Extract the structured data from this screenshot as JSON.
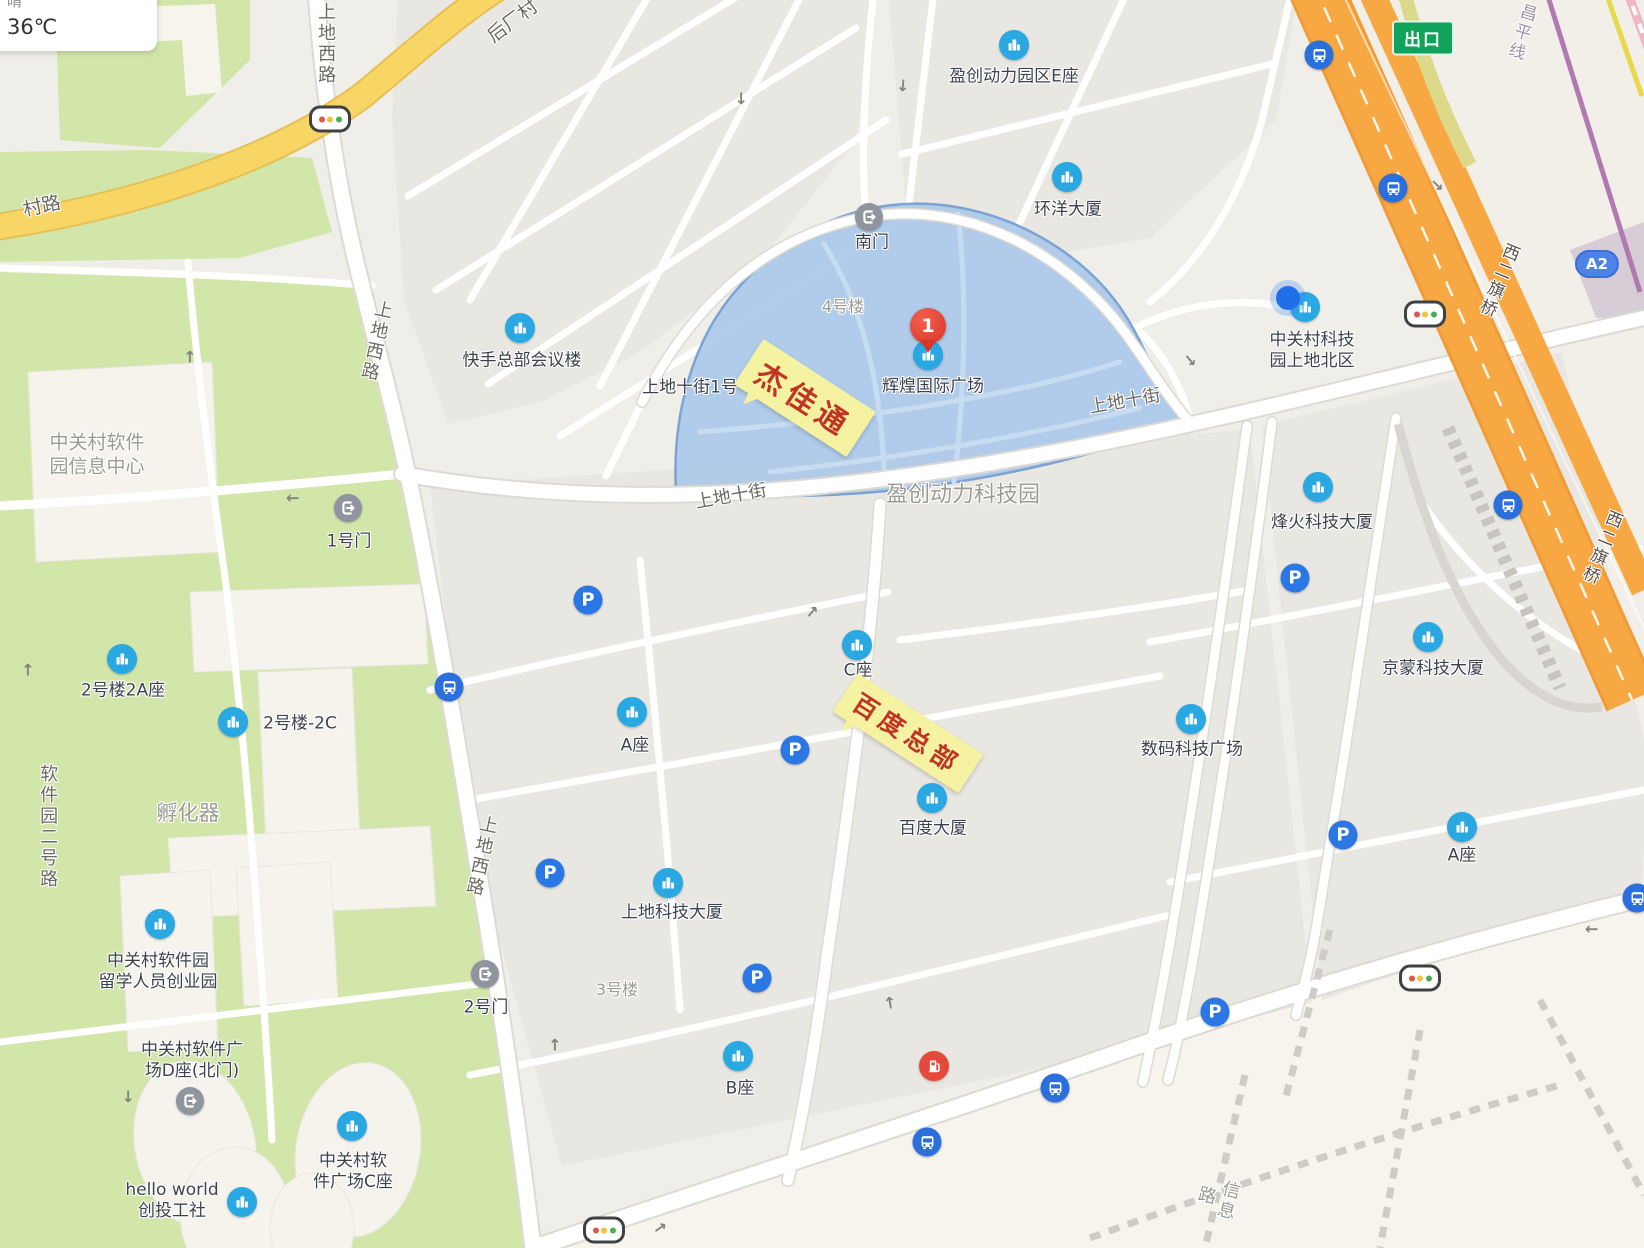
{
  "app": {
    "weather": {
      "condition": "晴",
      "temperature": "36℃"
    }
  },
  "marker": {
    "number": "1",
    "place": "辉煌国际广场",
    "x": 928,
    "y": 352
  },
  "callouts": [
    {
      "text": "杰佳通",
      "x": 805,
      "y": 398,
      "rotate": 33,
      "font_size": 30
    },
    {
      "text": "百度总部",
      "x": 908,
      "y": 733,
      "rotate": 33,
      "font_size": 25
    }
  ],
  "badges": [
    {
      "text": "出口",
      "type": "exit",
      "x": 1423,
      "y": 38
    },
    {
      "text": "A2",
      "type": "roadno",
      "x": 1597,
      "y": 264
    }
  ],
  "labels": [
    {
      "t": "盈创动力园区E座",
      "x": 1014,
      "y": 77,
      "c": "poi"
    },
    {
      "t": "环洋大厦",
      "x": 1068,
      "y": 210,
      "c": "poi"
    },
    {
      "t": "快手总部会议楼",
      "x": 522,
      "y": 361,
      "c": "poi"
    },
    {
      "t": "辉煌国际广场",
      "x": 933,
      "y": 387,
      "c": "poi"
    },
    {
      "t": "中关村科技\n园上地北区",
      "x": 1312,
      "y": 351,
      "c": "poi"
    },
    {
      "t": "烽火科技大厦",
      "x": 1322,
      "y": 523,
      "c": "poi"
    },
    {
      "t": "京蒙科技大厦",
      "x": 1433,
      "y": 669,
      "c": "poi"
    },
    {
      "t": "数码科技广场",
      "x": 1192,
      "y": 750,
      "c": "poi"
    },
    {
      "t": "A座",
      "x": 1462,
      "y": 856,
      "c": "poi"
    },
    {
      "t": "2号楼2A座",
      "x": 123,
      "y": 691,
      "c": "poi"
    },
    {
      "t": "2号楼-2C",
      "x": 300,
      "y": 724,
      "c": "poi"
    },
    {
      "t": "中关村软件园\n留学人员创业园",
      "x": 158,
      "y": 972,
      "c": "poi"
    },
    {
      "t": "中关村软件广\n场D座(北门)",
      "x": 192,
      "y": 1061,
      "c": "poi"
    },
    {
      "t": "hello world\n创投工社",
      "x": 172,
      "y": 1201,
      "c": "poi"
    },
    {
      "t": "中关村软\n件广场C座",
      "x": 353,
      "y": 1172,
      "c": "poi"
    },
    {
      "t": "A座",
      "x": 635,
      "y": 746,
      "c": "poi"
    },
    {
      "t": "上地科技大厦",
      "x": 672,
      "y": 913,
      "c": "poi"
    },
    {
      "t": "B座",
      "x": 740,
      "y": 1089,
      "c": "poi"
    },
    {
      "t": "百度大厦",
      "x": 933,
      "y": 829,
      "c": "poi"
    },
    {
      "t": "C座",
      "x": 858,
      "y": 671,
      "c": "poi"
    },
    {
      "t": "1号门",
      "x": 349,
      "y": 542,
      "c": "poi"
    },
    {
      "t": "2号门",
      "x": 486,
      "y": 1008,
      "c": "poi"
    },
    {
      "t": "南门",
      "x": 872,
      "y": 243,
      "c": "poi"
    },
    {
      "t": "上地十街1号",
      "x": 690,
      "y": 388,
      "c": "poi"
    },
    {
      "t": "中关村软件\n园信息中心",
      "x": 97,
      "y": 455,
      "c": "grey",
      "size": 19
    },
    {
      "t": "孵化器",
      "x": 188,
      "y": 813,
      "c": "grey",
      "size": 21
    },
    {
      "t": "4号楼",
      "x": 843,
      "y": 307,
      "c": "grey",
      "size": 16
    },
    {
      "t": "3号楼",
      "x": 617,
      "y": 990,
      "c": "grey",
      "size": 16
    },
    {
      "t": "盈创动力科技园",
      "x": 963,
      "y": 495,
      "c": "grey",
      "size": 22
    },
    {
      "t": "信息路",
      "x": 1216,
      "y": 1198,
      "c": "grey",
      "size": 18,
      "vert": true,
      "rot": 14
    },
    {
      "t": "上地西路",
      "x": 325,
      "y": 44,
      "c": "road",
      "vert": true
    },
    {
      "t": "上地西路",
      "x": 375,
      "y": 341,
      "c": "road",
      "vert": true,
      "rot": 12
    },
    {
      "t": "上地西路",
      "x": 480,
      "y": 856,
      "c": "road",
      "vert": true,
      "rot": 12
    },
    {
      "t": "后厂村",
      "x": 513,
      "y": 22,
      "c": "road",
      "rot": -37,
      "size": 19
    },
    {
      "t": "村路",
      "x": 42,
      "y": 207,
      "c": "road",
      "rot": -12,
      "size": 19
    },
    {
      "t": "软件园二号路",
      "x": 47,
      "y": 827,
      "c": "road",
      "vert": true
    },
    {
      "t": "上地十街",
      "x": 731,
      "y": 497,
      "c": "road",
      "rot": -10
    },
    {
      "t": "上地十街",
      "x": 1125,
      "y": 402,
      "c": "road",
      "rot": -10
    },
    {
      "t": "西二旗桥",
      "x": 1497,
      "y": 280,
      "c": "road",
      "vert": true,
      "rot": 22,
      "color": "#55524c",
      "size": 17
    },
    {
      "t": "西二旗桥",
      "x": 1600,
      "y": 547,
      "c": "road",
      "vert": true,
      "rot": 22,
      "color": "#55524c",
      "size": 17
    },
    {
      "t": "昌平线",
      "x": 1520,
      "y": 32,
      "c": "road",
      "vert": true,
      "rot": 17,
      "color": "#a08fa8",
      "size": 17
    }
  ],
  "icons": [
    {
      "t": "building",
      "x": 1014,
      "y": 45
    },
    {
      "t": "building",
      "x": 1067,
      "y": 177
    },
    {
      "t": "building",
      "x": 520,
      "y": 328
    },
    {
      "t": "building",
      "x": 928,
      "y": 355
    },
    {
      "t": "building",
      "x": 1305,
      "y": 307
    },
    {
      "t": "building",
      "x": 1318,
      "y": 487
    },
    {
      "t": "building",
      "x": 1428,
      "y": 637
    },
    {
      "t": "building",
      "x": 1191,
      "y": 719
    },
    {
      "t": "building",
      "x": 1462,
      "y": 827
    },
    {
      "t": "building",
      "x": 122,
      "y": 659
    },
    {
      "t": "building",
      "x": 233,
      "y": 722
    },
    {
      "t": "building",
      "x": 160,
      "y": 924
    },
    {
      "t": "building",
      "x": 242,
      "y": 1202
    },
    {
      "t": "building",
      "x": 352,
      "y": 1126
    },
    {
      "t": "building",
      "x": 632,
      "y": 712
    },
    {
      "t": "building",
      "x": 668,
      "y": 883
    },
    {
      "t": "building",
      "x": 738,
      "y": 1056
    },
    {
      "t": "building",
      "x": 932,
      "y": 798
    },
    {
      "t": "building",
      "x": 857,
      "y": 645
    },
    {
      "t": "parking",
      "x": 588,
      "y": 600
    },
    {
      "t": "parking",
      "x": 795,
      "y": 750
    },
    {
      "t": "parking",
      "x": 550,
      "y": 873
    },
    {
      "t": "parking",
      "x": 757,
      "y": 978
    },
    {
      "t": "parking",
      "x": 1295,
      "y": 578
    },
    {
      "t": "parking",
      "x": 1343,
      "y": 835
    },
    {
      "t": "parking",
      "x": 1215,
      "y": 1012
    },
    {
      "t": "bus",
      "x": 449,
      "y": 687
    },
    {
      "t": "bus",
      "x": 1319,
      "y": 55
    },
    {
      "t": "bus",
      "x": 1393,
      "y": 188
    },
    {
      "t": "bus",
      "x": 1508,
      "y": 505
    },
    {
      "t": "bus",
      "x": 1055,
      "y": 1088
    },
    {
      "t": "bus",
      "x": 927,
      "y": 1142
    },
    {
      "t": "bus",
      "x": 1637,
      "y": 898
    },
    {
      "t": "gate",
      "x": 869,
      "y": 217
    },
    {
      "t": "gate",
      "x": 348,
      "y": 508
    },
    {
      "t": "gate",
      "x": 485,
      "y": 974
    },
    {
      "t": "gate",
      "x": 190,
      "y": 1101
    },
    {
      "t": "gas",
      "x": 934,
      "y": 1066
    },
    {
      "t": "traffic",
      "x": 330,
      "y": 119
    },
    {
      "t": "traffic",
      "x": 1425,
      "y": 314
    },
    {
      "t": "traffic",
      "x": 1420,
      "y": 978
    },
    {
      "t": "traffic",
      "x": 604,
      "y": 1230
    },
    {
      "t": "locdot",
      "x": 1288,
      "y": 298
    }
  ],
  "arrows": [
    {
      "x": 741,
      "y": 98,
      "rot": 180
    },
    {
      "x": 190,
      "y": 357,
      "rot": 0
    },
    {
      "x": 293,
      "y": 498,
      "rot": -90
    },
    {
      "x": 812,
      "y": 612,
      "rot": 40
    },
    {
      "x": 555,
      "y": 1045,
      "rot": 0
    },
    {
      "x": 660,
      "y": 1228,
      "rot": 55
    },
    {
      "x": 890,
      "y": 1003,
      "rot": -10
    },
    {
      "x": 1592,
      "y": 929,
      "rot": -90
    },
    {
      "x": 1190,
      "y": 360,
      "rot": 140
    },
    {
      "x": 28,
      "y": 670,
      "rot": 0
    },
    {
      "x": 903,
      "y": 85,
      "rot": 185
    },
    {
      "x": 128,
      "y": 1096,
      "rot": 180
    },
    {
      "x": 1437,
      "y": 185,
      "rot": 135
    }
  ],
  "colors": {
    "poi_blue": "#29a8e2",
    "parking_blue": "#2b78e4",
    "bus_blue": "#2b6fdd",
    "pin_red": "#da3425",
    "highlight_fill": "#abc9e9",
    "highway_orange": "#f7a843",
    "road_yellow": "#f8d666",
    "park_green": "#d3e6aa",
    "subway_purple": "#b07ab0",
    "exit_green": "#0fa35b"
  }
}
